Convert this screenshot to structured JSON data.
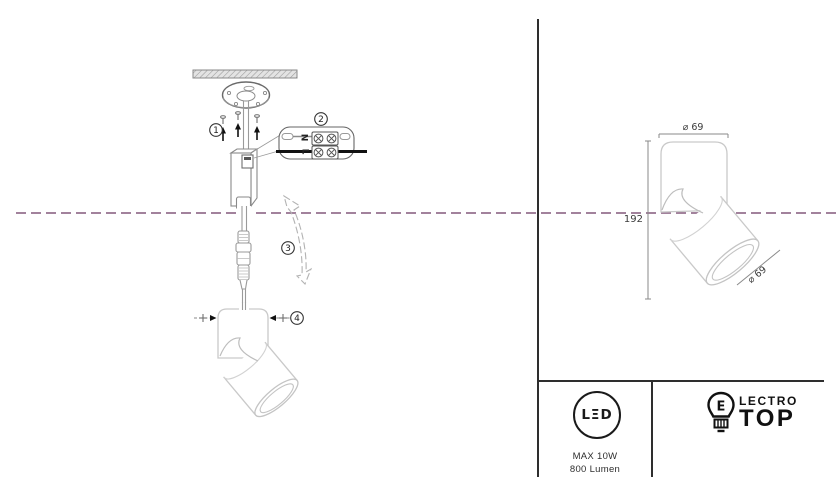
{
  "colors": {
    "centerline": "#a2829c",
    "ink": "#1a1a1a",
    "line_light": "#c9c9c9",
    "line_mid": "#8f8f8f",
    "divider": "#2e2e2e"
  },
  "installation": {
    "step1": "1",
    "step2": "2",
    "step3": "3",
    "step4": "4",
    "terminal_neutral": "N",
    "terminal_live": "L"
  },
  "dimensions": {
    "top_diameter": "⌀ 69",
    "height": "192",
    "head_diameter": "⌀ 69"
  },
  "spec": {
    "led_logo": "LΞD",
    "max_power": "MAX 10W",
    "luminous_flux": "800 Lumen"
  },
  "brand": {
    "bulb_letter": "E",
    "name_rest": "LECTRO",
    "name_bottom": "TOP"
  }
}
